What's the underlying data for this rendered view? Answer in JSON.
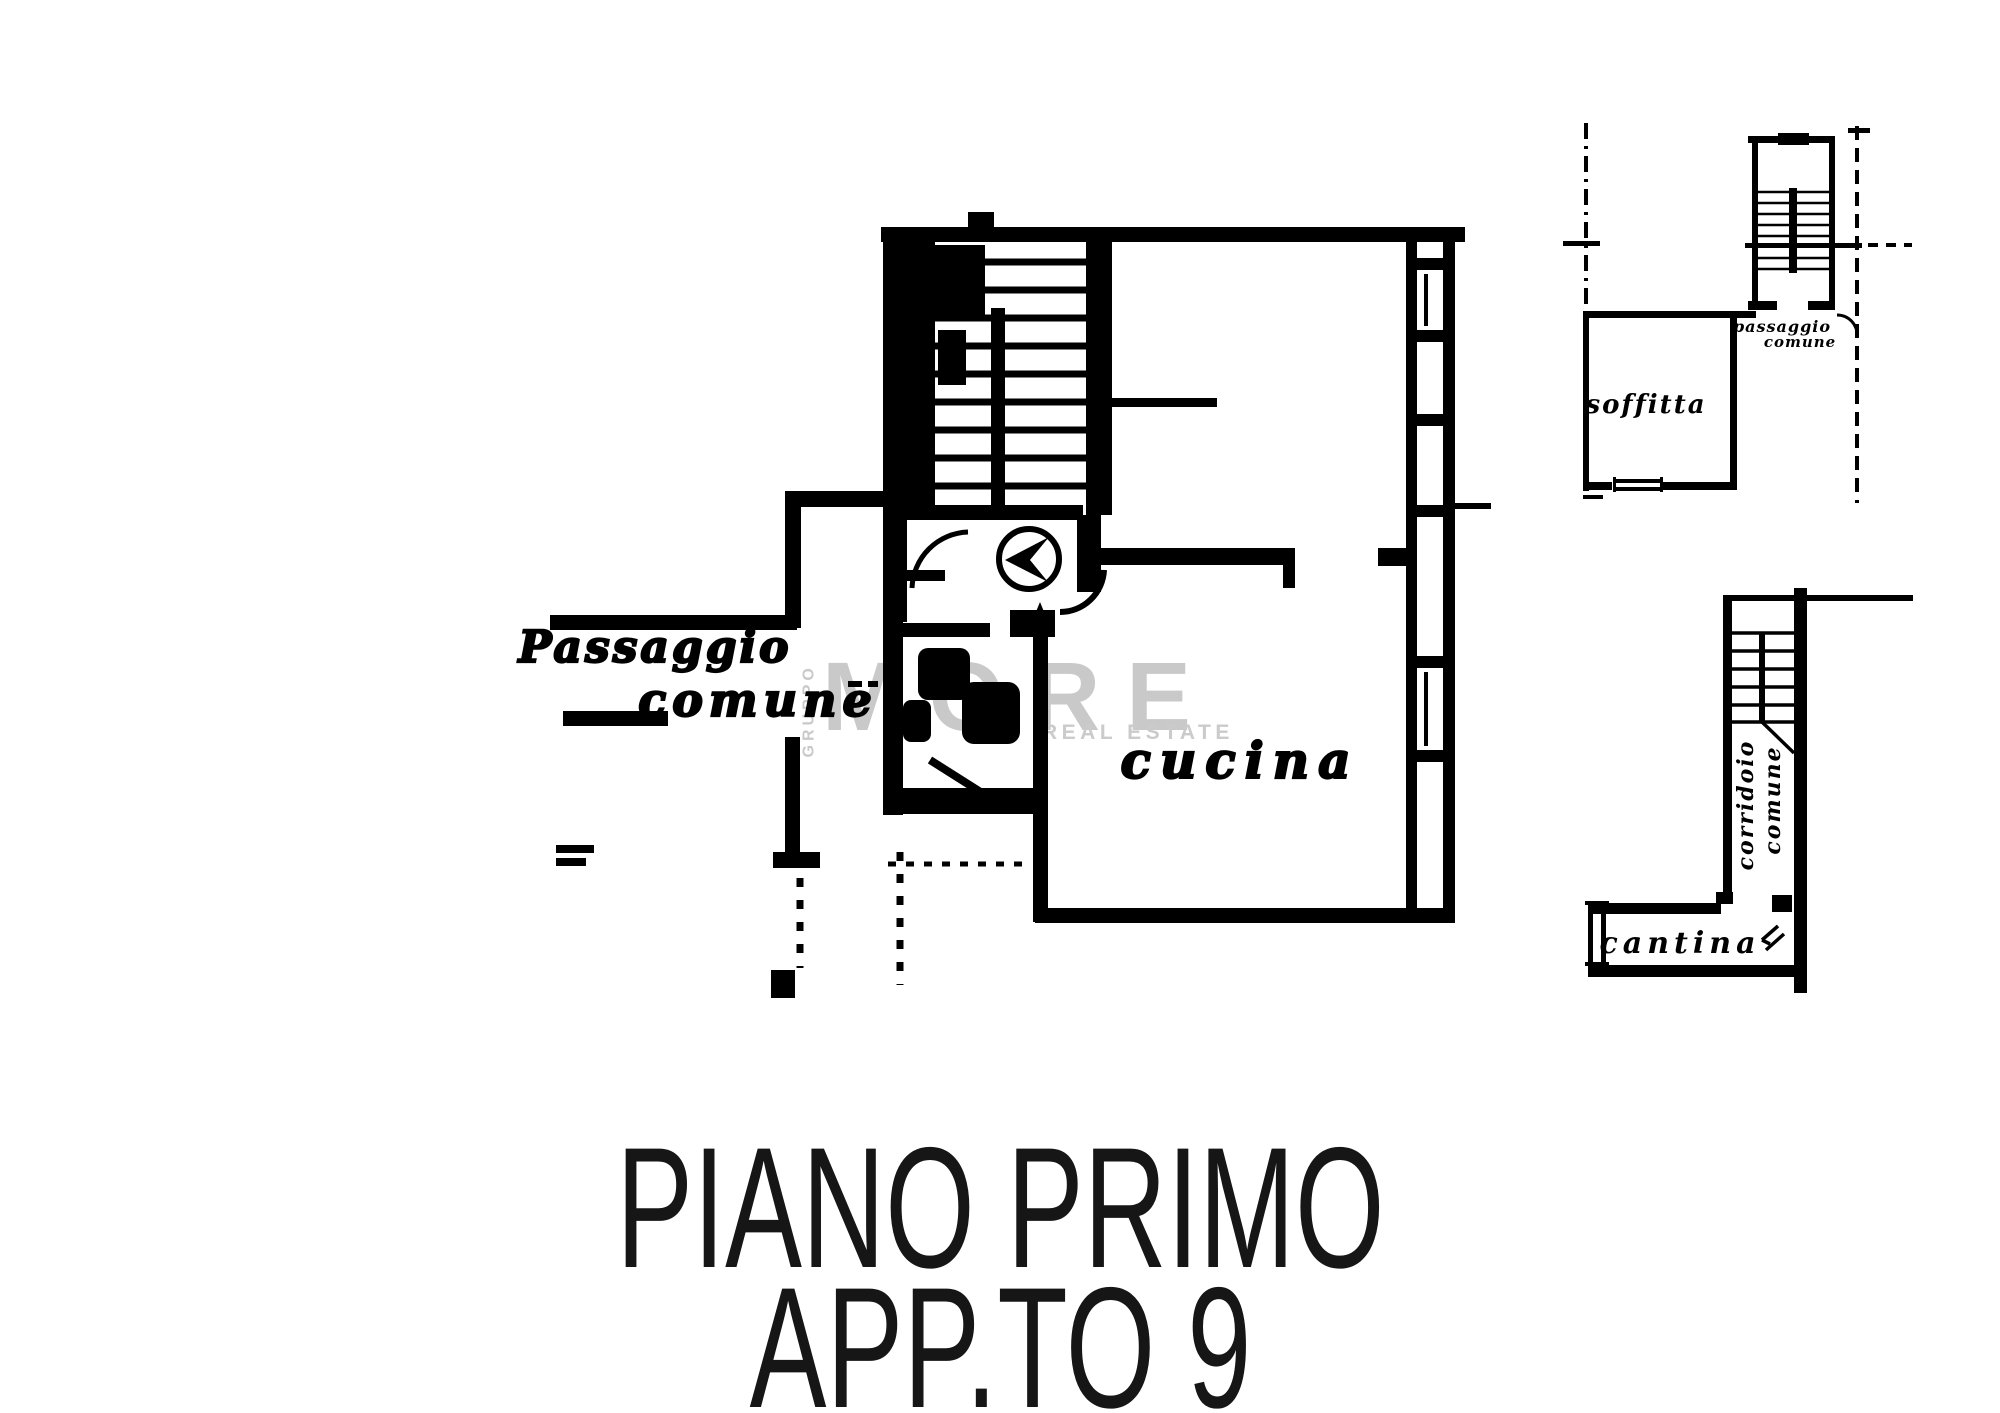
{
  "page": {
    "background": "#ffffff"
  },
  "title": {
    "line1": "PIANO PRIMO",
    "line2": "APP.TO 9"
  },
  "watermark": {
    "group": "GRUPPO",
    "brand": "MORE",
    "tagline": "REAL ESTATE"
  },
  "main_plan": {
    "label_passaggio": "Passaggio",
    "label_comune": "comune",
    "label_cucina": "cucina"
  },
  "soffitta_plan": {
    "label_passaggio": "passaggio",
    "label_comune": "comune",
    "label_soffitta": "soffitta"
  },
  "cantina_plan": {
    "label_corridoio": "corridoio",
    "label_comune": "comune",
    "label_cantina": "cantina"
  },
  "icons": {
    "north_arrow": "triangle-in-circle",
    "stair_direction": "up-arrow"
  },
  "colors": {
    "ink": "#000000",
    "watermark_gray": "#c9c9c9",
    "title": "#161616"
  }
}
